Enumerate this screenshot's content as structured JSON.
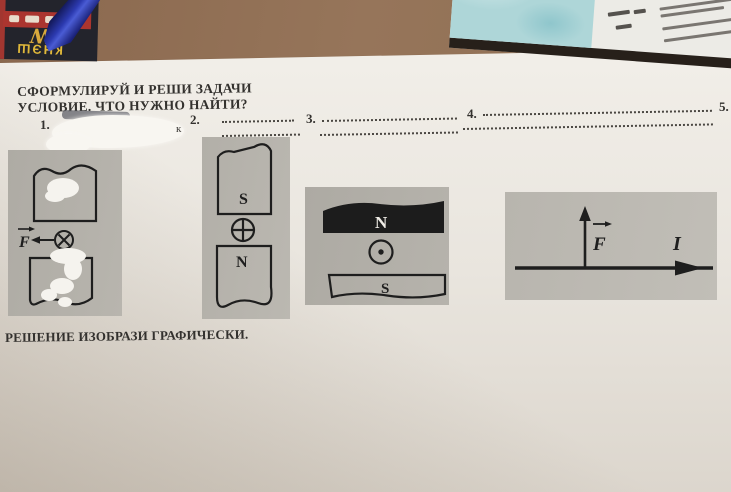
{
  "worksheet": {
    "heading_line1": "СФОРМУЛИРУЙ И РЕШИ ЗАДАЧИ",
    "heading_line2": "УСЛОВИЕ. ЧТО НУЖНО НАЙТИ?",
    "items": [
      {
        "number": "1."
      },
      {
        "number": "2."
      },
      {
        "number": "3."
      },
      {
        "number": "4."
      },
      {
        "number": "5."
      }
    ],
    "item1_fragment": "к",
    "footer": "РЕШЕНИЕ ИЗОБРАЗИ ГРАФИЧЕСКИ."
  },
  "diagrams": {
    "d1": {
      "force_label": "F",
      "current_symbol": "current-into-page"
    },
    "d2": {
      "top_pole": "S",
      "bottom_pole": "N",
      "current_symbol": "current-into-page"
    },
    "d3": {
      "top_pole": "N",
      "bottom_pole": "S",
      "current_symbol": "current-out-of-page"
    },
    "d4": {
      "force_label": "F",
      "current_label": "I"
    }
  },
  "desk_objects": {
    "notebook_logo": "W",
    "notebook_title": "КНЭШ"
  },
  "colors": {
    "desk_wood": "#8d6b51",
    "paper": "#e9e5de",
    "panel_gray": "#b5b2ab",
    "ink": "#1e1e1e",
    "notebook_red": "#ab352f",
    "notebook_yellow": "#e0b83a",
    "pen_blue": "#2c3ab0",
    "map_teal": "#aed6d8"
  }
}
